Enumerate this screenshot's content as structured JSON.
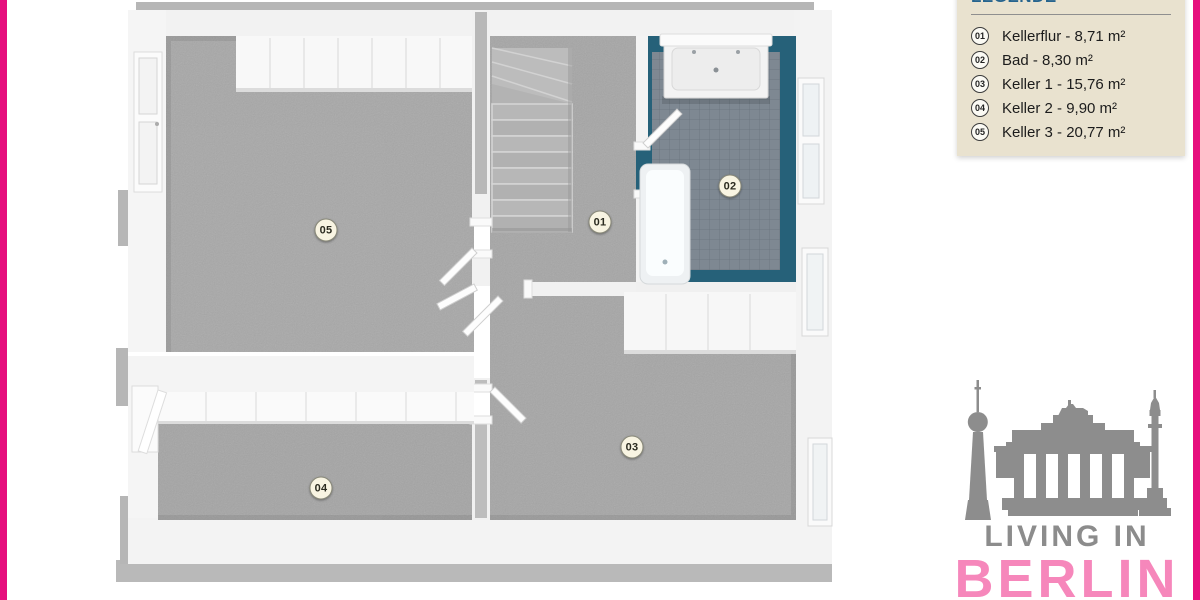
{
  "page": {
    "background": "#ffffff",
    "accent_pink": "#e60f7e"
  },
  "legend": {
    "title": "LEGENDE",
    "title_color": "#26648e",
    "panel_bg": "#e9e2cf",
    "items": [
      {
        "num": "01",
        "label": "Kellerflur - 8,71 m²"
      },
      {
        "num": "02",
        "label": "Bad - 8,30 m²"
      },
      {
        "num": "03",
        "label": "Keller 1 - 15,76 m²"
      },
      {
        "num": "04",
        "label": "Keller 2 - 9,90 m²"
      },
      {
        "num": "05",
        "label": "Keller 3 - 20,77 m²"
      }
    ]
  },
  "floorplan": {
    "room_labels": [
      {
        "num": "01"
      },
      {
        "num": "02"
      },
      {
        "num": "03"
      },
      {
        "num": "04"
      },
      {
        "num": "05"
      }
    ],
    "colors": {
      "floor_gray": "#a6a6a6",
      "wall_white": "#f2f2f2",
      "wall_top_gray": "#b6b6b6",
      "bath_tile_field": "#7e8892",
      "bath_tile_border": "#266179"
    }
  },
  "logo": {
    "line1": "LIVING IN",
    "line2": "BERLIN",
    "line1_color": "#8c8c8c",
    "line2_color": "#f687bb",
    "skyline_color": "#8d8d8d"
  }
}
